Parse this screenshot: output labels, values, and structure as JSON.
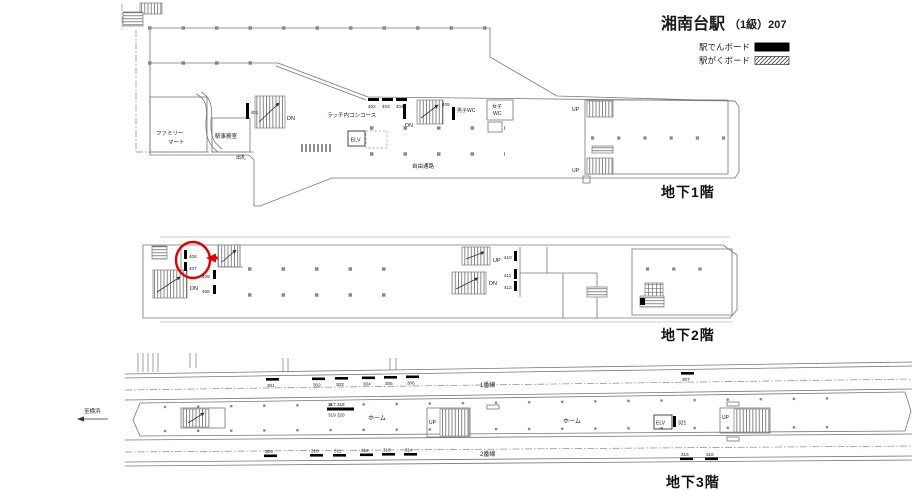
{
  "header": {
    "title_station": "湘南台駅",
    "title_grade": "（1級）207",
    "legend": [
      {
        "label": "駅でんボード",
        "swatch": "solid-black"
      },
      {
        "label": "駅がくボード",
        "swatch": "diagonal-hatch"
      }
    ]
  },
  "b1f": {
    "floor_name": "地下1階",
    "family_mart_line1": "ファミリー",
    "family_mart_line2": "マート",
    "station_office": "駅事務室",
    "ticket_window": "出札",
    "concourse_label": "ラッチ内コンコース",
    "free_passage": "自由通路",
    "mens_wc": "男子WC",
    "womens_wc_line1": "女子",
    "womens_wc_line2": "WC",
    "elevator": "ELV",
    "dn_left": "DN",
    "dn_mid": "DN",
    "up_top": "UP",
    "up_bottom": "UP",
    "board_401": "401",
    "board_402": "402",
    "board_403": "403",
    "board_404": "404",
    "board_405": "405"
  },
  "b2f": {
    "floor_name": "地下2階",
    "dn_left": "DN",
    "up_mid": "UP",
    "dn_mid": "DN",
    "board_406": "406",
    "board_407": "407",
    "board_408": "408",
    "board_409": "409",
    "board_410": "410",
    "board_411": "411",
    "board_412": "412"
  },
  "b3f": {
    "floor_name": "地下3階",
    "direction_yokohama": "至横浜",
    "track_1": "1番線",
    "track_2": "2番線",
    "platform_label_1": "ホーム",
    "platform_label_2": "ホーム",
    "elevator": "ELV",
    "up_mid": "UP",
    "up_right": "UP",
    "board_301": "301",
    "board_302": "302",
    "board_303": "303",
    "board_304": "304",
    "board_305": "305",
    "board_306": "306",
    "board_307": "307",
    "board_309": "309",
    "board_310": "310",
    "board_311": "311",
    "board_312": "312",
    "board_313": "313",
    "board_314": "314",
    "board_315": "315",
    "board_316": "316",
    "board_317_318": "317 318",
    "board_319_320": "319 320",
    "board_321": "321"
  }
}
